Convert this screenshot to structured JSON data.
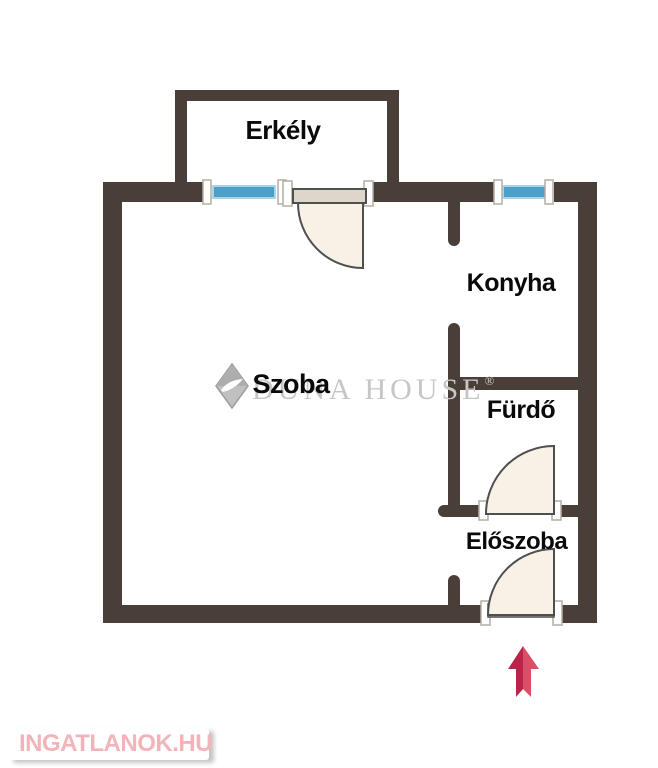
{
  "page": {
    "type": "floor-plan",
    "background": "#ffffff"
  },
  "floorplan": {
    "rooms": [
      {
        "id": "erkely",
        "label": "Erkély"
      },
      {
        "id": "szoba",
        "label": "Szoba"
      },
      {
        "id": "konyha",
        "label": "Konyha"
      },
      {
        "id": "furdo",
        "label": "Fürdő"
      },
      {
        "id": "eloszoba",
        "label": "Előszoba"
      }
    ],
    "windows_count": 2,
    "doors": [
      "balcony-door",
      "bathroom-door",
      "entrance-door"
    ],
    "entrance_arrow_direction": "up"
  },
  "watermark": {
    "brand": "DUNA HOUSE",
    "registered": "®"
  },
  "footer_logo": {
    "text": "INGATLANOK.HU"
  },
  "colors": {
    "wall": "#4a3f38",
    "window_blue": "#4c9fc8",
    "window_blue_light": "#a9d5e9",
    "door_fill": "#f8f2e6",
    "door_leaf": "#ded6ca",
    "door_outline": "#4f4f4f",
    "jamb_outline": "#b3ada3",
    "watermark_gray": "#c6c6c6",
    "logo_pink": "#f2b4b8",
    "arrow_dark": "#bb2449",
    "arrow_light": "#d84f67"
  }
}
